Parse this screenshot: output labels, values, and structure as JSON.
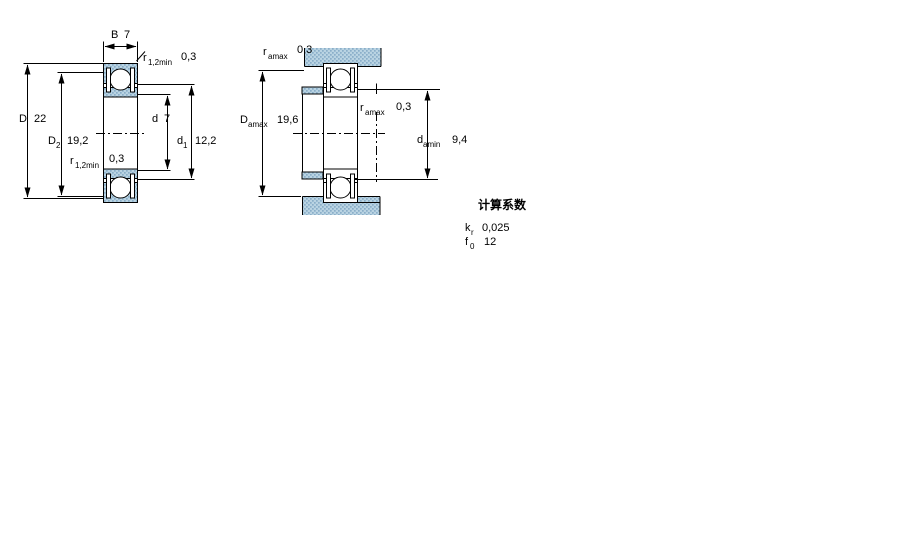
{
  "drawing_title": "bearing-dimension-drawing",
  "left_diagram": {
    "description": "bearing cross-section with boundary dimensions",
    "dims": {
      "B": {
        "label": "B",
        "value": "7"
      },
      "r12_top": {
        "label": "r",
        "sub": "1,2min",
        "value": "0,3"
      },
      "D": {
        "label": "D",
        "value": "22"
      },
      "D2": {
        "label": "D",
        "sub": "2",
        "value": "19,2"
      },
      "d": {
        "label": "d",
        "value": "7"
      },
      "d1": {
        "label": "d",
        "sub": "1",
        "value": "12,2"
      },
      "r12_bot": {
        "label": "r",
        "sub": "1,2min",
        "value": "0,3"
      }
    }
  },
  "right_diagram": {
    "description": "bearing mounted with shaft and housing abutment dimensions",
    "dims": {
      "ra_top": {
        "label": "r",
        "sub": "amax",
        "value": "0,3"
      },
      "Da": {
        "label": "D",
        "sub": "amax",
        "value": "19,6"
      },
      "ra_mid": {
        "label": "r",
        "sub": "amax",
        "value": "0,3"
      },
      "da": {
        "label": "d",
        "sub": "amin",
        "value": "9,4"
      }
    }
  },
  "calculation_factors": {
    "heading": "计算系数",
    "rows": [
      {
        "label": "k",
        "sub": "r",
        "value": "0,025"
      },
      {
        "label": "f",
        "sub": "0",
        "value": "12"
      }
    ]
  },
  "colors": {
    "section_fill_base": "#b9d3e2",
    "section_fill_dot": "#8aaec9",
    "line": "#000000",
    "background": "#ffffff"
  }
}
